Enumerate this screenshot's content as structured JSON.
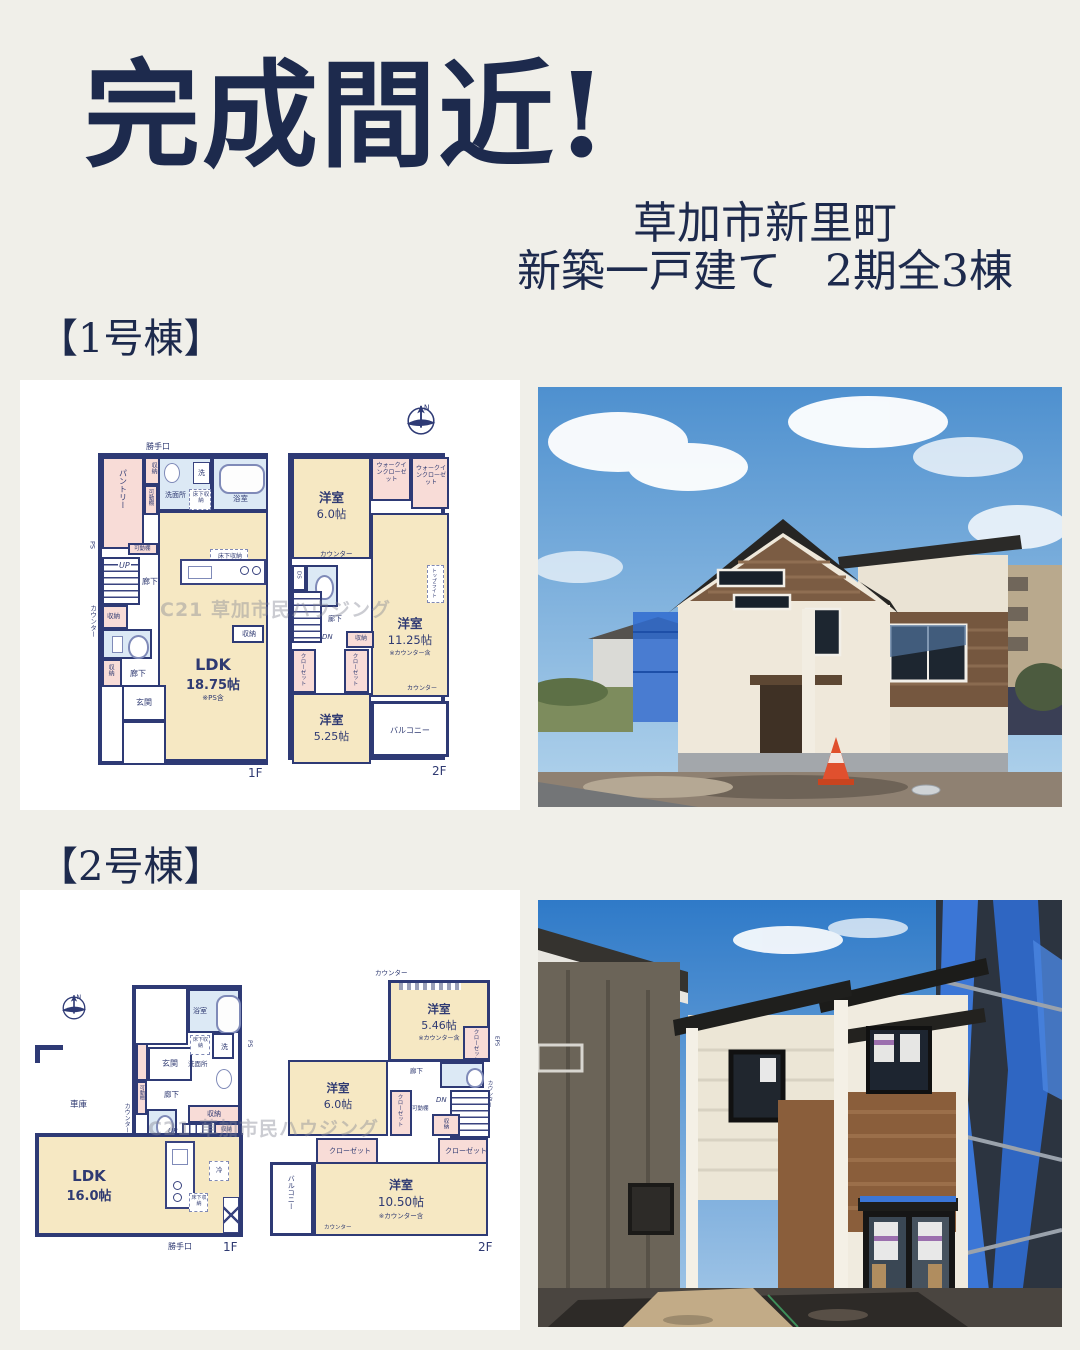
{
  "page": {
    "background": "#f0efe9",
    "title_color": "#1d2a4d",
    "plan_wall_color": "#2e3a75",
    "plan_room_cream": "#f6e8c3",
    "plan_room_pink": "#f8dcd7",
    "plan_room_blue": "#dce9f5"
  },
  "header": {
    "title": "完成間近!",
    "subtitle_line1": "草加市新里町",
    "subtitle_line2": "新築一戸建て　2期全3棟"
  },
  "section1": {
    "heading": "【1号棟】"
  },
  "section2": {
    "heading": "【2号棟】"
  },
  "terms": {
    "north": "N",
    "back_door": "勝手口",
    "pantry": "パントリー",
    "storage": "収納",
    "movable_shelf": "可動棚",
    "washroom": "洗面所",
    "laundry": "洗",
    "underfloor_storage": "床下収納",
    "bathroom": "浴室",
    "fridge": "冷",
    "ps": "PS",
    "up": "UP",
    "dn": "DN",
    "ds": "DS",
    "hallway": "廊下",
    "counter": "カウンター",
    "entrance": "玄関",
    "western_room": "洋室",
    "walkin_closet": "ウォークインクローゼット",
    "eps": "EPS",
    "closet": "クローゼット",
    "top_light": "トップライト",
    "balcony": "バルコニー",
    "garage": "車庫",
    "floor_1f": "1F",
    "floor_2f": "2F",
    "watermark": "C21 草加市民ハウジング"
  },
  "plan1": {
    "ldk": "LDK",
    "ldk_size": "18.75帖",
    "ldk_note": "※PS含",
    "room_a_size": "6.0帖",
    "room_b_size": "11.25帖",
    "room_b_note": "※カウンター含",
    "room_c_size": "5.25帖"
  },
  "plan2": {
    "ldk": "LDK",
    "ldk_size": "16.0帖",
    "room_a_size": "5.46帖",
    "room_a_note": "※カウンター含",
    "room_b_size": "6.0帖",
    "room_c_size": "10.50帖",
    "room_c_note": "※カウンター含"
  }
}
